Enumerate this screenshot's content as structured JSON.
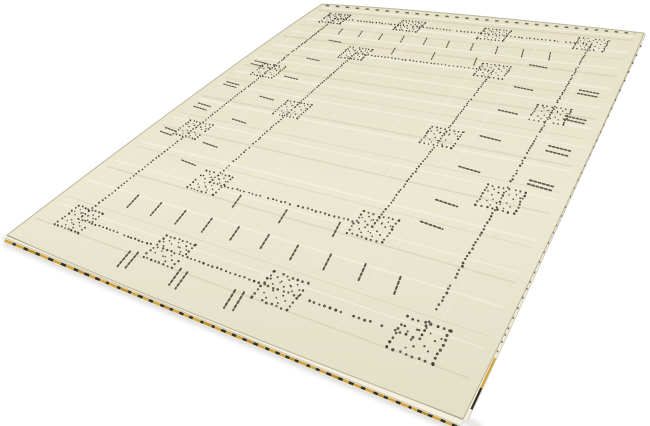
{
  "scene": {
    "type": "product-photo-of-rug",
    "background_color": "#ffffff"
  },
  "rug": {
    "corners": {
      "tl": [
        322,
        4
      ],
      "tr": [
        644,
        33
      ],
      "br": [
        463,
        419
      ],
      "bl": [
        7,
        235
      ]
    },
    "design_size": {
      "w": 100,
      "h": 140
    },
    "colors": {
      "base_top": "#e6e1c8",
      "base_mid": "#ece8d2",
      "base_bottom": "#e3dec6",
      "face_outline": "rgba(146,136,104,0.55)",
      "motif": "#46413a",
      "weave_light": "rgba(255,255,255,0.45)",
      "weave_dark": "rgba(146,134,98,0.13)",
      "side_band": "#f4f0e0",
      "side_band_right": "#f1edda",
      "side_edge_line": "#c9c3ae",
      "side_crease": "rgba(125,117,92,0.5)",
      "side_shade": "rgba(155,147,120,0.45)",
      "side_sliver": "#e9e5d3",
      "selvage_gold": "#d2a440",
      "selvage_gold_dark": "#bd8e2e",
      "selvage_dark": "#352f26",
      "edge_dash": "rgba(70,61,46,0.72)",
      "shadow": "#8e8e88"
    },
    "pattern": {
      "outer_frame": {
        "left": 11,
        "top": 11,
        "right": 89,
        "bottom": 129
      },
      "inner_frame": {
        "left": 30,
        "top": 34,
        "right": 70,
        "bottom": 106
      },
      "dot_spacing": 1.05,
      "square_size": 7.4,
      "squares": [
        {
          "u": 11,
          "v": 11
        },
        {
          "u": 37,
          "v": 11
        },
        {
          "u": 63,
          "v": 11
        },
        {
          "u": 89,
          "v": 11
        },
        {
          "u": 11,
          "v": 52
        },
        {
          "u": 11,
          "v": 88
        },
        {
          "u": 89,
          "v": 52
        },
        {
          "u": 89,
          "v": 88
        },
        {
          "u": 11,
          "v": 129
        },
        {
          "u": 37,
          "v": 129
        },
        {
          "u": 63,
          "v": 129
        },
        {
          "u": 89,
          "v": 129
        },
        {
          "u": 30,
          "v": 34
        },
        {
          "u": 70,
          "v": 34
        },
        {
          "u": 30,
          "v": 70
        },
        {
          "u": 70,
          "v": 70
        },
        {
          "u": 30,
          "v": 106
        },
        {
          "u": 70,
          "v": 106
        }
      ],
      "diamond_offsets": [
        [
          -2.1,
          -1.7
        ],
        [
          0.1,
          -1.9
        ],
        [
          2.2,
          -1.6
        ],
        [
          -1.2,
          1.7
        ],
        [
          1.3,
          1.9
        ]
      ],
      "tick_rows": [
        {
          "dir": "v",
          "v": 21,
          "u": [
            18,
            25,
            32,
            39,
            46,
            53,
            60,
            67,
            74,
            81
          ],
          "double": false
        },
        {
          "dir": "v",
          "v": 30,
          "u": [
            40,
            52,
            64
          ],
          "double": false
        },
        {
          "dir": "v",
          "v": 110,
          "u": [
            40,
            52,
            64
          ],
          "double": false
        },
        {
          "dir": "v",
          "v": 119,
          "u": [
            18,
            25,
            32,
            39,
            46,
            53,
            60,
            67,
            74,
            81
          ],
          "double": false
        },
        {
          "dir": "v",
          "v": 134.5,
          "u": [
            30,
            43,
            56
          ],
          "double": true
        },
        {
          "dir": "h",
          "u": 20,
          "v": [
            28,
            41,
            54,
            67,
            80,
            93,
            101
          ],
          "double": false
        },
        {
          "dir": "h",
          "u": 5.5,
          "v": [
            48,
            62,
            76,
            90
          ],
          "double": true
        },
        {
          "dir": "h",
          "u": 80,
          "v": [
            28,
            41,
            54,
            67,
            80,
            93,
            101
          ],
          "double": false
        },
        {
          "dir": "h",
          "u": 94.5,
          "v": [
            38,
            52,
            66,
            80
          ],
          "double": true
        }
      ],
      "tick_half_len": 2.3,
      "weave_line_count": 26,
      "warp_streak_count": 8
    },
    "side": {
      "bottom_band_width_start": 4.5,
      "bottom_band_width_end": 8,
      "right_band_width_start": 2,
      "right_band_width_end": 5
    }
  }
}
